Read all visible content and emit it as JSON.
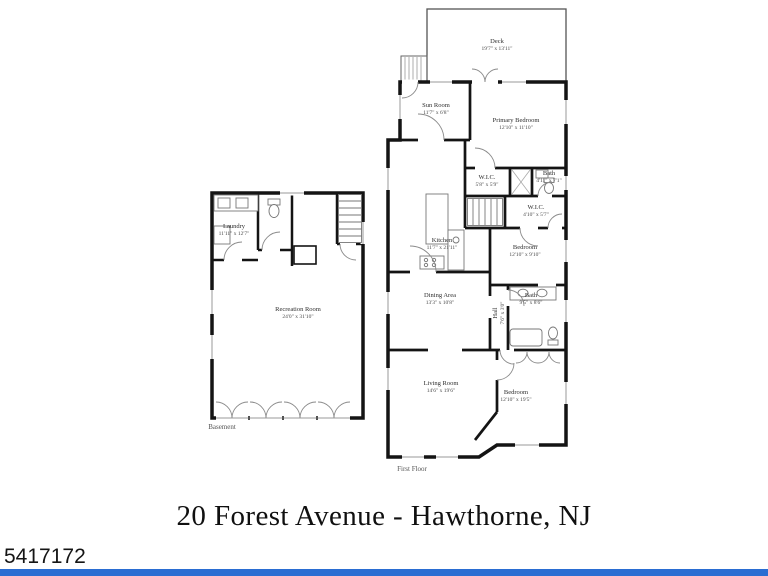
{
  "page": {
    "title": "20 Forest Avenue - Hawthorne, NJ",
    "watermark_id": "5417172",
    "footer_bar_color": "#2a6dd2",
    "wall_color": "#141414"
  },
  "basement": {
    "label": "Basement",
    "rooms": [
      {
        "name": "Laundry",
        "dims": "11'11\" x 12'7\""
      },
      {
        "name": "Recreation Room",
        "dims": "24'0\" x 31'10\""
      }
    ]
  },
  "first_floor": {
    "label": "First Floor",
    "rooms": [
      {
        "name": "Deck",
        "dims": "19'7\" x 13'11\""
      },
      {
        "name": "Sun Room",
        "dims": "11'7\" x 6'8\""
      },
      {
        "name": "Primary Bedroom",
        "dims": "12'10\" x 11'10\""
      },
      {
        "name": "W.I.C.",
        "dims": "5'8\" x 5'9\""
      },
      {
        "name": "Bath",
        "dims": "4'11\" x 7'1\""
      },
      {
        "name": "W.I.C.",
        "dims": "4'10\" x 5'7\""
      },
      {
        "name": "Kitchen",
        "dims": "11'7\" x 21'11\""
      },
      {
        "name": "Bedroom",
        "dims": "12'10\" x 9'10\""
      },
      {
        "name": "Dining Area",
        "dims": "13'3\" x 10'8\""
      },
      {
        "name": "Hall",
        "dims": "7'6\" x 3'0\""
      },
      {
        "name": "Bath",
        "dims": "9'5\" x 8'6\""
      },
      {
        "name": "Living Room",
        "dims": "14'6\" x 19'6\""
      },
      {
        "name": "Bedroom",
        "dims": "12'10\" x 19'5\""
      }
    ]
  }
}
